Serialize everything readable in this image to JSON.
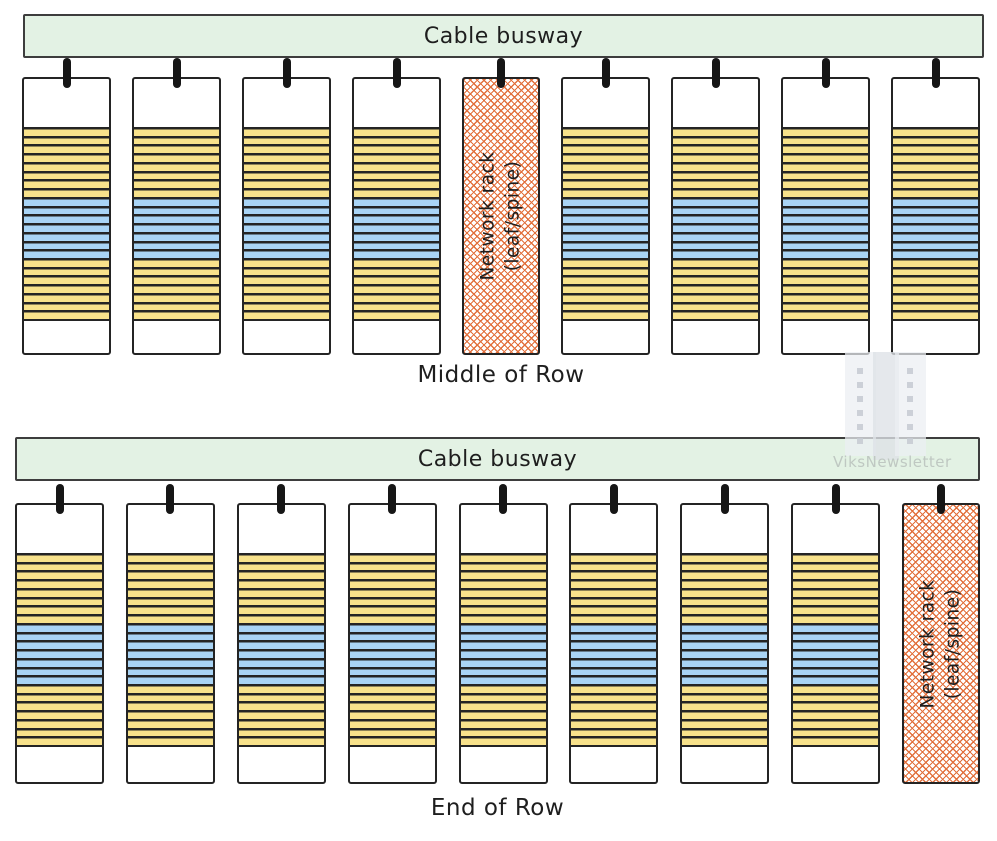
{
  "diagram": {
    "title_hidden": "",
    "colors": {
      "busway_fill": "#e3f2e4",
      "server_stripe_yellow": "#f8e28b",
      "switch_stripe_blue": "#a9d4f5",
      "network_rack_hatch_orange": "#e2703c",
      "outline_dark": "#242424",
      "watermark_gray": "#bfc8c2"
    },
    "network_label": {
      "line1": "Network rack",
      "line2": "(leaf/spine)"
    },
    "rack_sections": [
      {
        "name": "server-unit-stripe",
        "color_key": "server_stripe_yellow",
        "count": 8
      },
      {
        "name": "switch-unit-stripe",
        "color_key": "switch_stripe_blue",
        "count": 7
      },
      {
        "name": "server-unit-stripe",
        "color_key": "server_stripe_yellow",
        "count": 7
      }
    ],
    "rows": [
      {
        "id": "middle-of-row",
        "busway_label": "Cable busway",
        "caption": "Middle of Row",
        "racks": [
          "server",
          "server",
          "server",
          "server",
          "network",
          "server",
          "server",
          "server",
          "server"
        ]
      },
      {
        "id": "end-of-row",
        "busway_label": "Cable busway",
        "caption": "End of Row",
        "racks": [
          "server",
          "server",
          "server",
          "server",
          "server",
          "server",
          "server",
          "server",
          "network"
        ]
      }
    ],
    "watermark": {
      "text": "ViksNewsletter"
    }
  }
}
